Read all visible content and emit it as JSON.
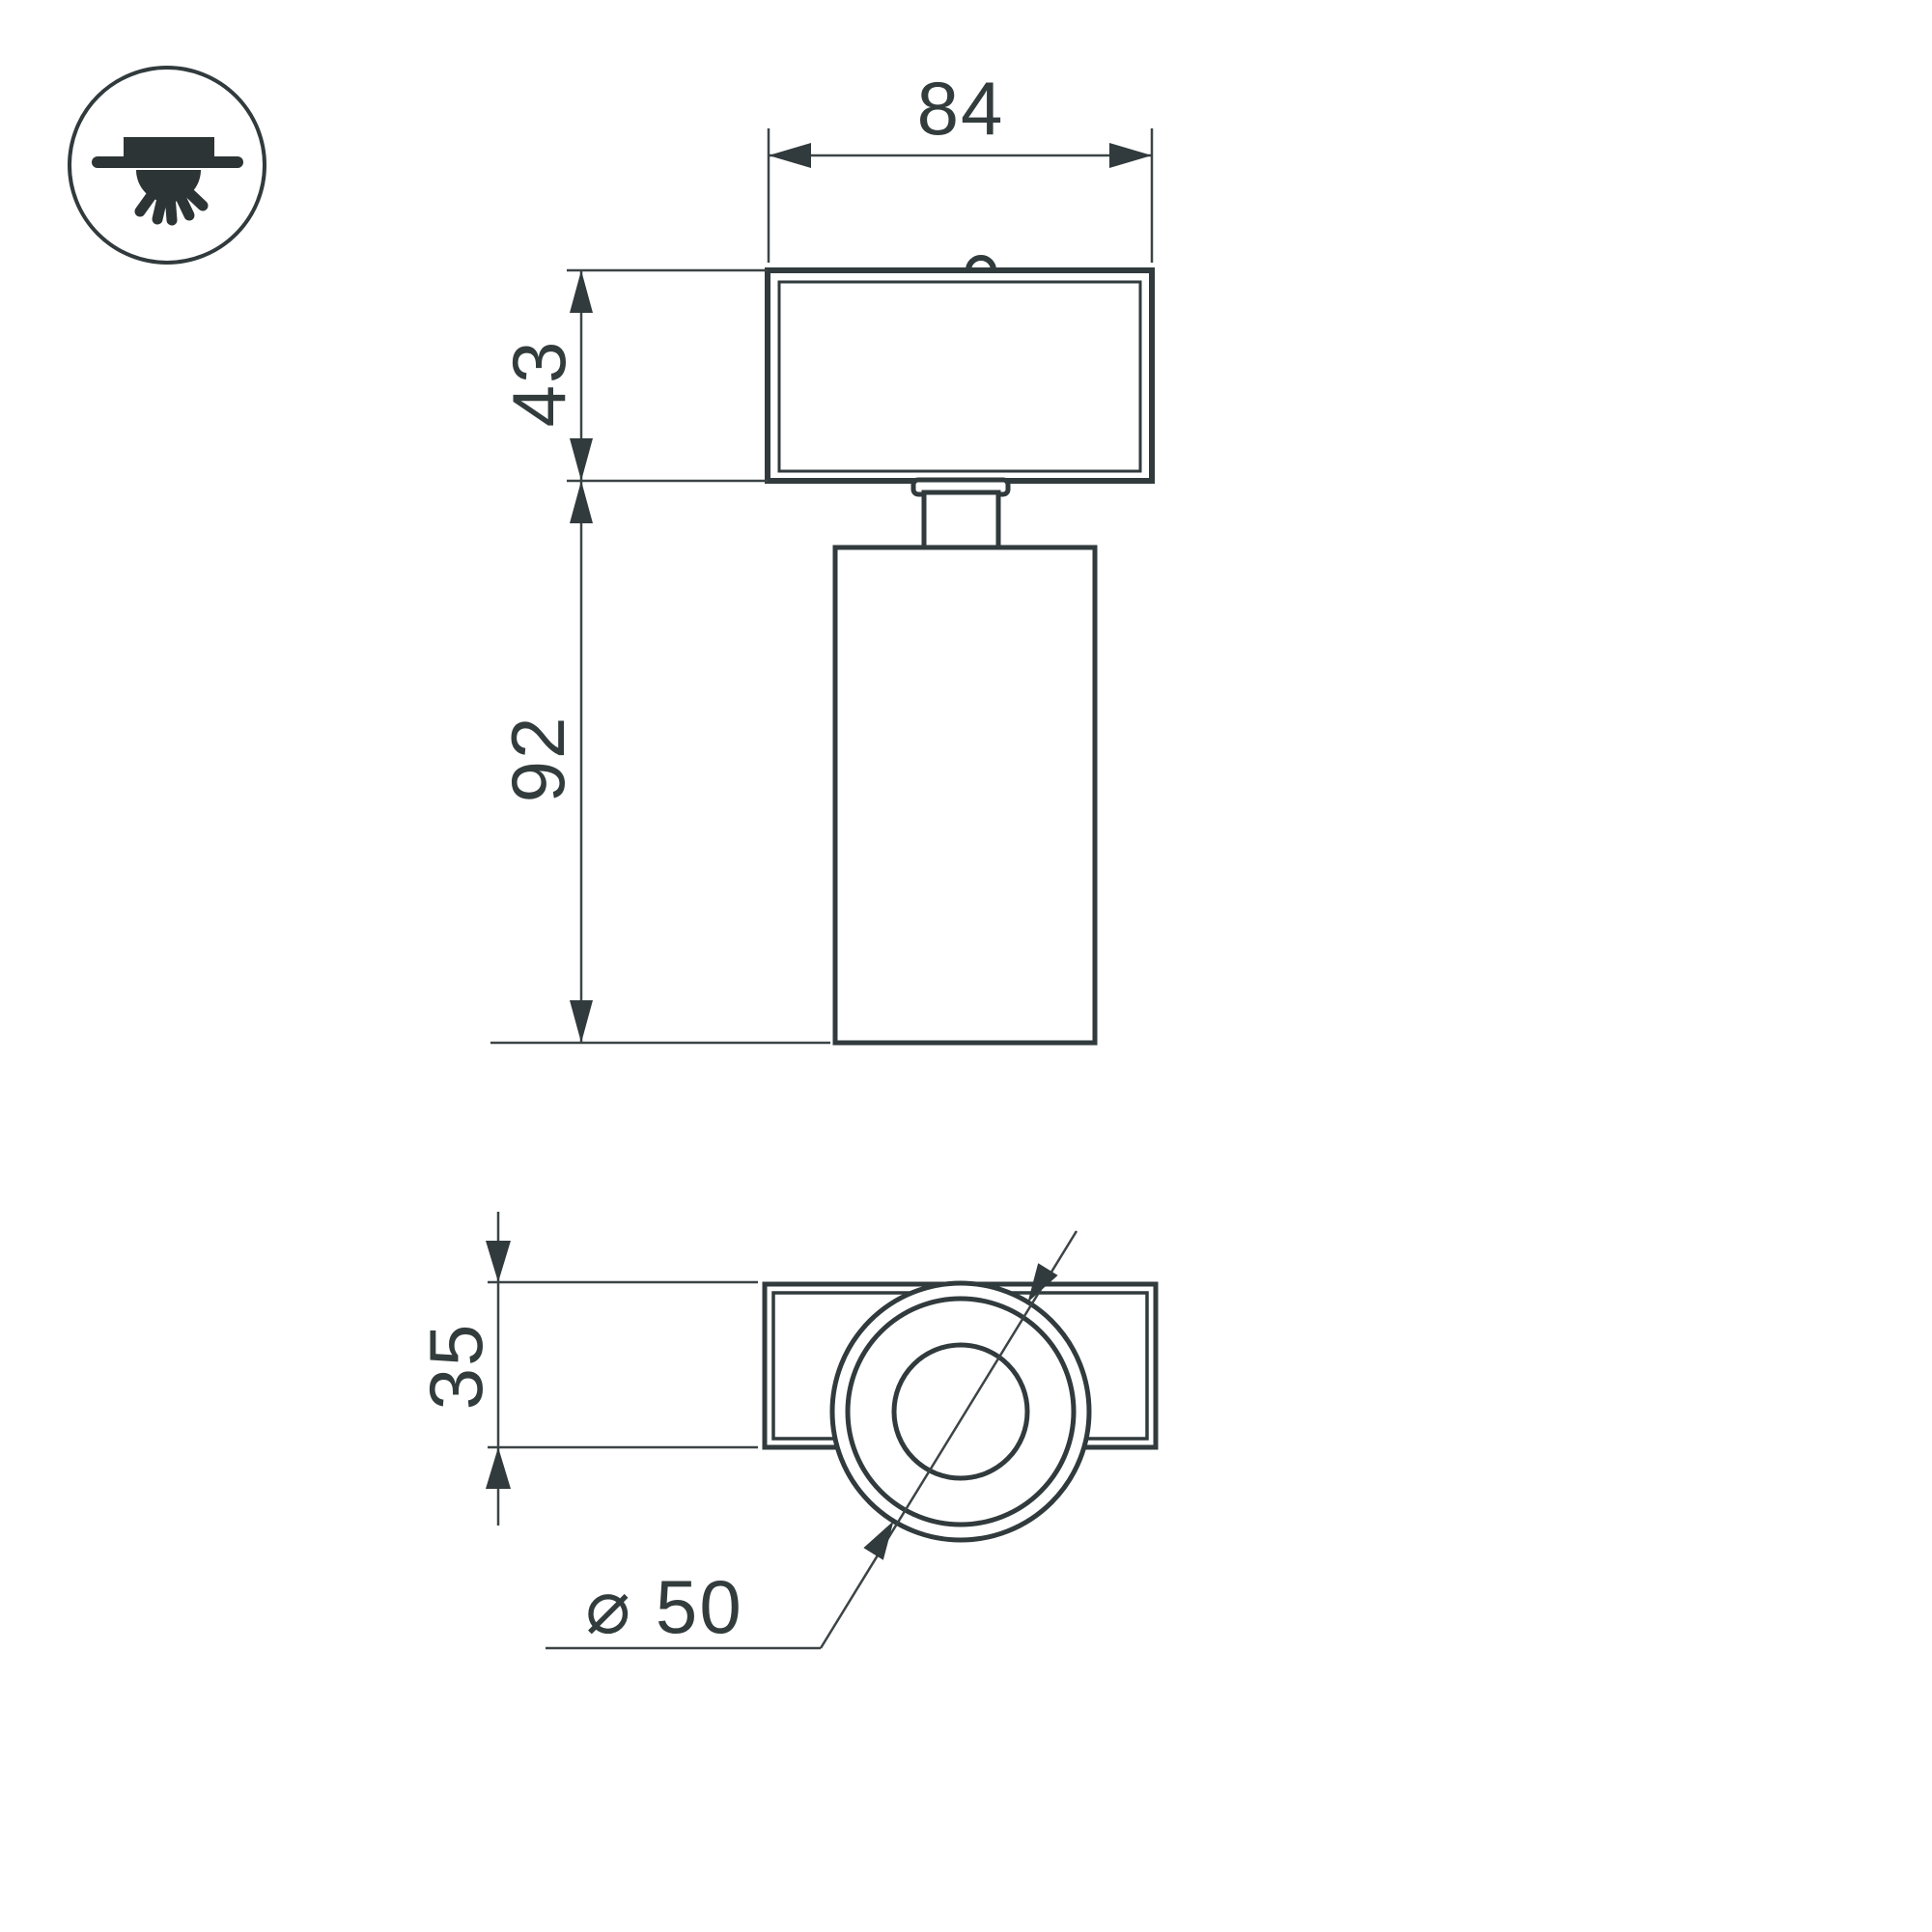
{
  "page": {
    "background": "#ffffff",
    "line_color": "#313a3c",
    "thin_line_color": "#3c4446",
    "text_color": "#333c3d"
  },
  "icon": {
    "name": "surface-ceiling-mount-light-icon"
  },
  "views": {
    "front_view": "front elevation of spot luminaire",
    "bottom_view": "bottom view of spot luminaire"
  },
  "dimensions": {
    "track_width": "84",
    "head_height": "43",
    "body_height": "92",
    "base_depth": "35",
    "diameter": "⌀ 50"
  }
}
